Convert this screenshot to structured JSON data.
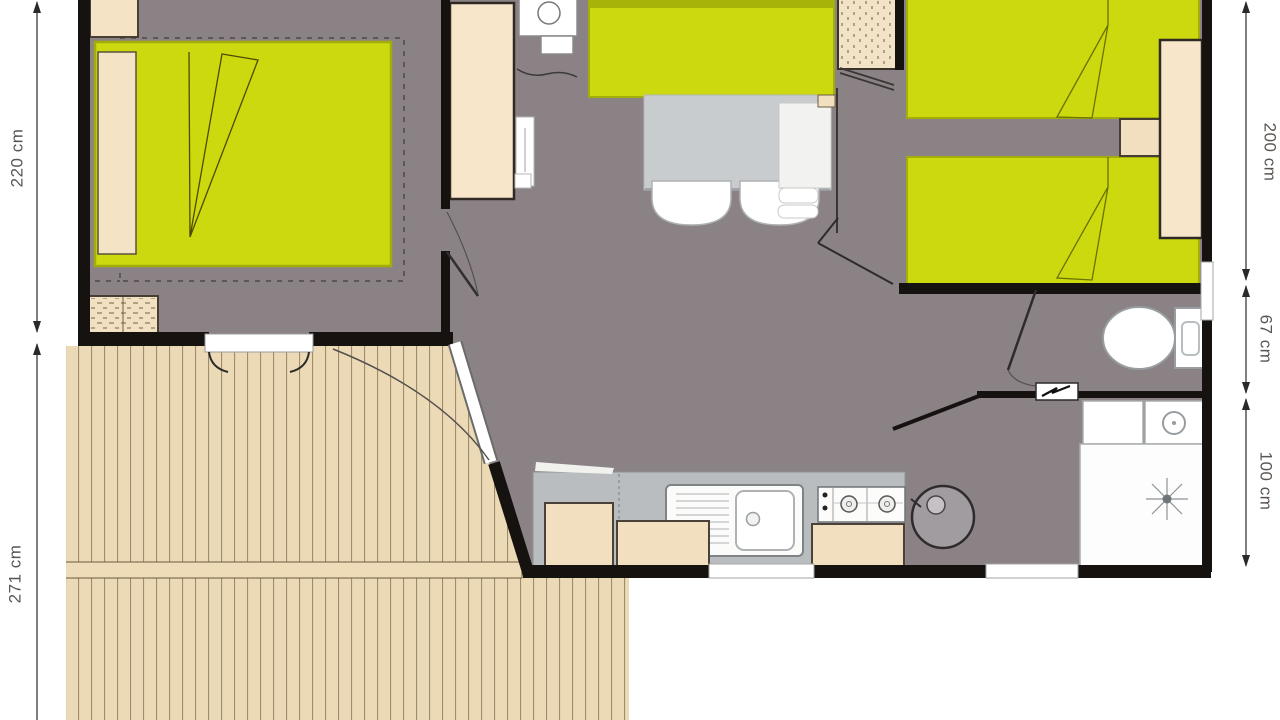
{
  "dimensions": {
    "left": [
      {
        "label": "220 cm",
        "edge": "left",
        "section": "bedroom-1-depth"
      },
      {
        "label": "271 cm",
        "edge": "left",
        "section": "terrace-depth"
      }
    ],
    "right": [
      {
        "label": "200 cm",
        "edge": "right",
        "section": "bedroom-2-depth"
      },
      {
        "label": "67 cm",
        "edge": "right",
        "section": "wc-depth"
      },
      {
        "label": "100 cm",
        "edge": "right",
        "section": "bathroom-depth"
      }
    ]
  },
  "colors": {
    "background": "#ffffff",
    "floor": "#8b8286",
    "walls": "#151210",
    "furniture_green": "#cbd90e",
    "furniture_beige": "#f5e3c6",
    "deck_wood": "#ecdab6",
    "table_gray": "#c8ccce",
    "counter_gray": "#b9bdbf",
    "fixture_white": "#ffffff"
  },
  "icons": {
    "toilet-icon": "ellipse bowl with cistern rectangle",
    "shower-icon": "star sprinkler rays with center dot",
    "sink-icon": "circle basin with center dot",
    "hob-icon": "two burner circles with knob dots",
    "electric-panel-icon": "lightning zigzag in white box",
    "water-heater-icon": "large gray circle with small dial",
    "boiler-icon": "white box with circle",
    "dimension-arrow-icon": "double-headed measuring arrow"
  }
}
